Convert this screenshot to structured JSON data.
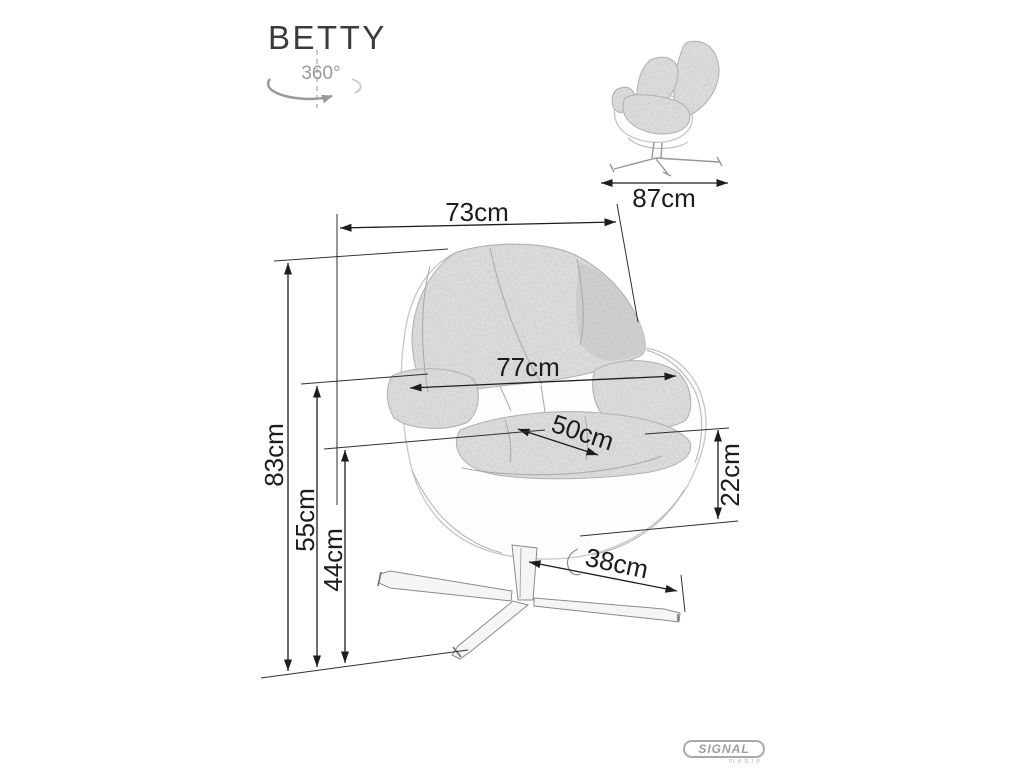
{
  "title": "BETTY",
  "rotation": {
    "label": "360°"
  },
  "dimensions": {
    "overall_width": "73cm",
    "depth": "87cm",
    "inner_width": "77cm",
    "seat_width": "50cm",
    "overall_height": "83cm",
    "arm_height": "55cm",
    "seat_height": "44cm",
    "seat_to_arm": "22cm",
    "base_leg_length": "38cm"
  },
  "logo": {
    "brand": "SIGNAL",
    "subtext": "meble"
  }
}
